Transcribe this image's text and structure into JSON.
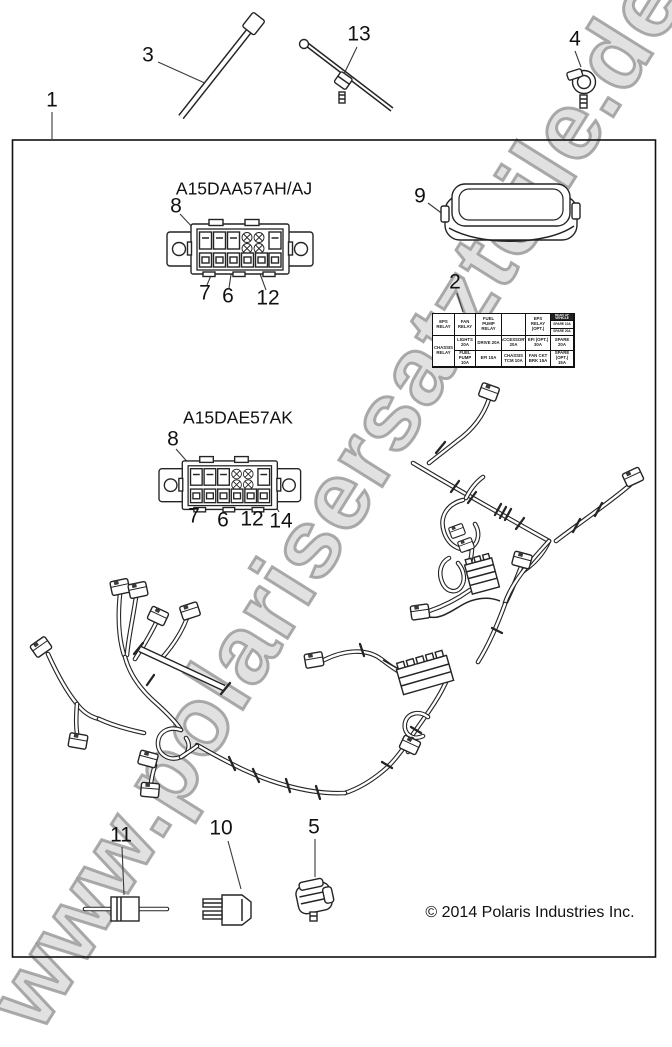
{
  "watermark": "www.polarisersatzteile.de",
  "copyright": "© 2014 Polaris Industries Inc.",
  "colors": {
    "line": "#1c1c1c",
    "watermark": "#c8c8c8",
    "background": "#ffffff"
  },
  "connectors": {
    "top_label": "A15DAA57AH/AJ",
    "bottom_label": "A15DAE57AK"
  },
  "callouts": {
    "n1": "1",
    "n2": "2",
    "n3": "3",
    "n4": "4",
    "n5": "5",
    "n6": "6",
    "n7": "7",
    "n8": "8",
    "n9": "9",
    "n10": "10",
    "n11": "11",
    "n12": "12",
    "n13": "13",
    "n14": "14"
  },
  "fuse_table": {
    "r1": [
      "EPS RELAY",
      "FAN RELAY",
      "FUEL PUMP RELAY",
      "",
      "EPS RELAY (OPT.)"
    ],
    "side": [
      "REAR OF VEHICLE",
      "SPARE 10A",
      "SPARE 20A"
    ],
    "r2": [
      "CHASSIS RELAY",
      "LIGHTS 20A",
      "DRIVE 20A",
      "ACCESSORY 20A",
      "EFI (OPT.) 30A",
      "SPARE 20A"
    ],
    "r3": [
      "FUEL PUMP 10A",
      "EFI 10A",
      "CHASSIS TCM 10A",
      "FAN CKT BRK 15A",
      "SPARE (OPT.) 15A"
    ]
  }
}
